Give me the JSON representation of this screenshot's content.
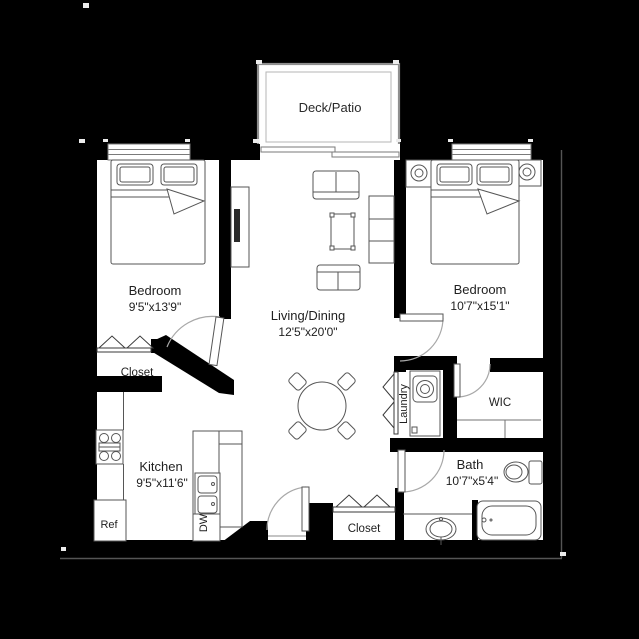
{
  "title": "2 Bedroom Apartment Floor Plan",
  "deck": {
    "label": "Deck/Patio"
  },
  "rooms": {
    "bedroom_left": {
      "name": "Bedroom",
      "dims": "9'5\"x13'9\""
    },
    "bedroom_right": {
      "name": "Bedroom",
      "dims": "10'7\"x15'1\""
    },
    "living": {
      "name": "Living/Dining",
      "dims": "12'5\"x20'0\""
    },
    "kitchen": {
      "name": "Kitchen",
      "dims": "9'5\"x11'6\""
    },
    "bath": {
      "name": "Bath",
      "dims": "10'7\"x5'4\""
    }
  },
  "labels": {
    "closet_left": "Closet",
    "closet_entry": "Closet",
    "laundry": "Laundry",
    "wic": "WIC",
    "refrigerator": "Ref",
    "dishwasher": "DW"
  },
  "colors": {
    "background": "#000000",
    "floor": "#ffffff",
    "wall": "#000000",
    "fixture_line": "#565656",
    "door_arc": "#a8a8a8",
    "text": "#1f1f1f",
    "deck_border": "#8f8f8f"
  }
}
